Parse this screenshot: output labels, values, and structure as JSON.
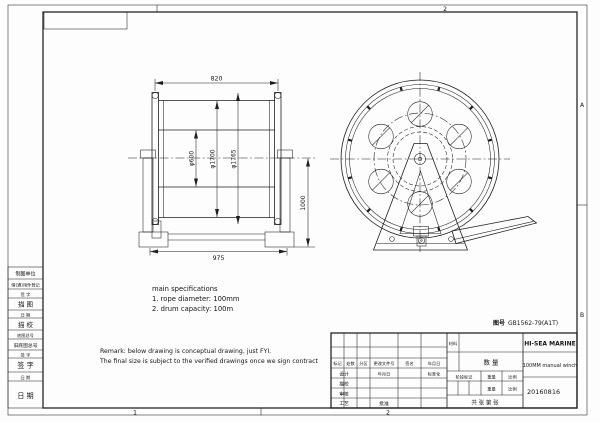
{
  "sheet": {
    "zones": {
      "top": "2",
      "bottom_left": "1",
      "bottom_right": "2",
      "right_upper": "A",
      "right_lower": "B"
    },
    "doc_no": {
      "label": "图号",
      "value": "GB1562-79(A1T)"
    }
  },
  "left_rows": [
    "制图单位",
    "借(通)用件登记",
    "签 字",
    "描 图",
    "日 期",
    "描 校",
    "底图总号",
    "旧底图总号",
    "签 字",
    "签 字",
    "日 期",
    "日 期"
  ],
  "specs": {
    "title": "main specifications",
    "items": [
      "1. rope diameter: 100mm",
      "2. drum capacity: 100m"
    ]
  },
  "remark": {
    "line1": "Remark: below drawing is conceptual drawing, just FYI.",
    "line2": "The final size is subject to the verified drawings once we sign contract"
  },
  "front_view": {
    "dim_width": "820",
    "dim_barrel": "φ600",
    "dim_rope_stack": "φ1700",
    "dim_flange": "φ1765",
    "dim_height": "1000",
    "dim_base": "975"
  },
  "title_block": {
    "rev_header": [
      "标记",
      "处数",
      "分区",
      "更改文件号",
      "签名",
      "年月日"
    ],
    "design": "设计",
    "date_col": "年月日",
    "standardization": "标准化",
    "trace_check": "描校",
    "review": "审核",
    "process": "工艺",
    "approve": "批准",
    "material": "材料",
    "quantity": "数 量",
    "stage": "阶段标记",
    "weight": "重量",
    "scale": "比例",
    "weight2": "重量",
    "scale2": "比例",
    "sheets": "共  张  第  张",
    "company": "HI-SEA MARINE",
    "product": "100MM manual winch",
    "date": "20160816"
  },
  "colors": {
    "line": "#1e1e1e",
    "paper": "#fdfdfd"
  }
}
